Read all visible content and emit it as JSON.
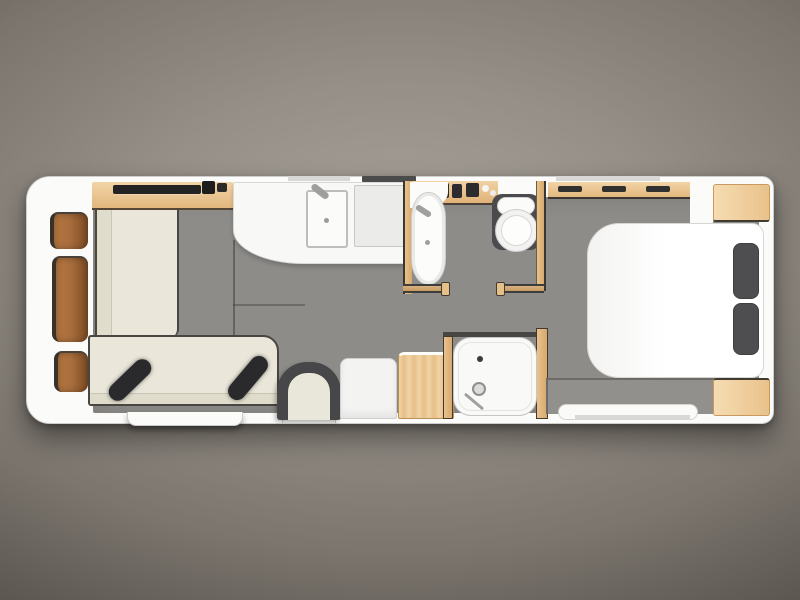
{
  "image": {
    "title": "caravan floor plan - top-down layout render",
    "width_px": 800,
    "height_px": 600
  },
  "palette": {
    "bg_center": "#a7a199",
    "bg_edge": "#34302b",
    "shell": "#fbfbfa",
    "floor": "#8d8c89",
    "wood_light": "#f0d2a4",
    "wood_mid": "#e2b87e",
    "locker_brown": "#a96e3d",
    "sofa_cream": "#eae7da",
    "cushion_black": "#2a2a2c",
    "bed_white": "#ffffff",
    "pillow_gray": "#4e4e50",
    "bench_gray": "#91908d",
    "metal_gray": "#9f9f9d",
    "window_line": "#d8d8d6",
    "fixture_white": "#fcfcfb",
    "toilet_surround": "#4b4b4d"
  },
  "zones": {
    "front": {
      "label": "front storage lockers",
      "locker_count": 3
    },
    "lounge": {
      "label": "front lounge",
      "features": [
        "sideboard with media units",
        "L-shaped cream sofa",
        "two black scatter cushions",
        "entrance step",
        "occasional chair",
        "entrance door"
      ]
    },
    "kitchen": {
      "label": "kitchen",
      "features": [
        "curved worktop",
        "sink with tap",
        "hob",
        "wall vent"
      ]
    },
    "storage": {
      "label": "mid cabinets",
      "features": [
        "fridge",
        "wooden cabinet"
      ]
    },
    "washroom": {
      "label": "washroom",
      "features": [
        "vanity with toiletries",
        "washbasin with tap",
        "toilet with cistern",
        "door opening"
      ]
    },
    "shower": {
      "label": "shower cubicle",
      "features": [
        "shower tray",
        "drain",
        "shower head with hose"
      ]
    },
    "bedroom": {
      "label": "rear bedroom",
      "features": [
        "overhead drawers with handles",
        "island double bed",
        "two pillows",
        "foot bench",
        "two bedside cabinets"
      ],
      "pillow_count": 2
    }
  }
}
